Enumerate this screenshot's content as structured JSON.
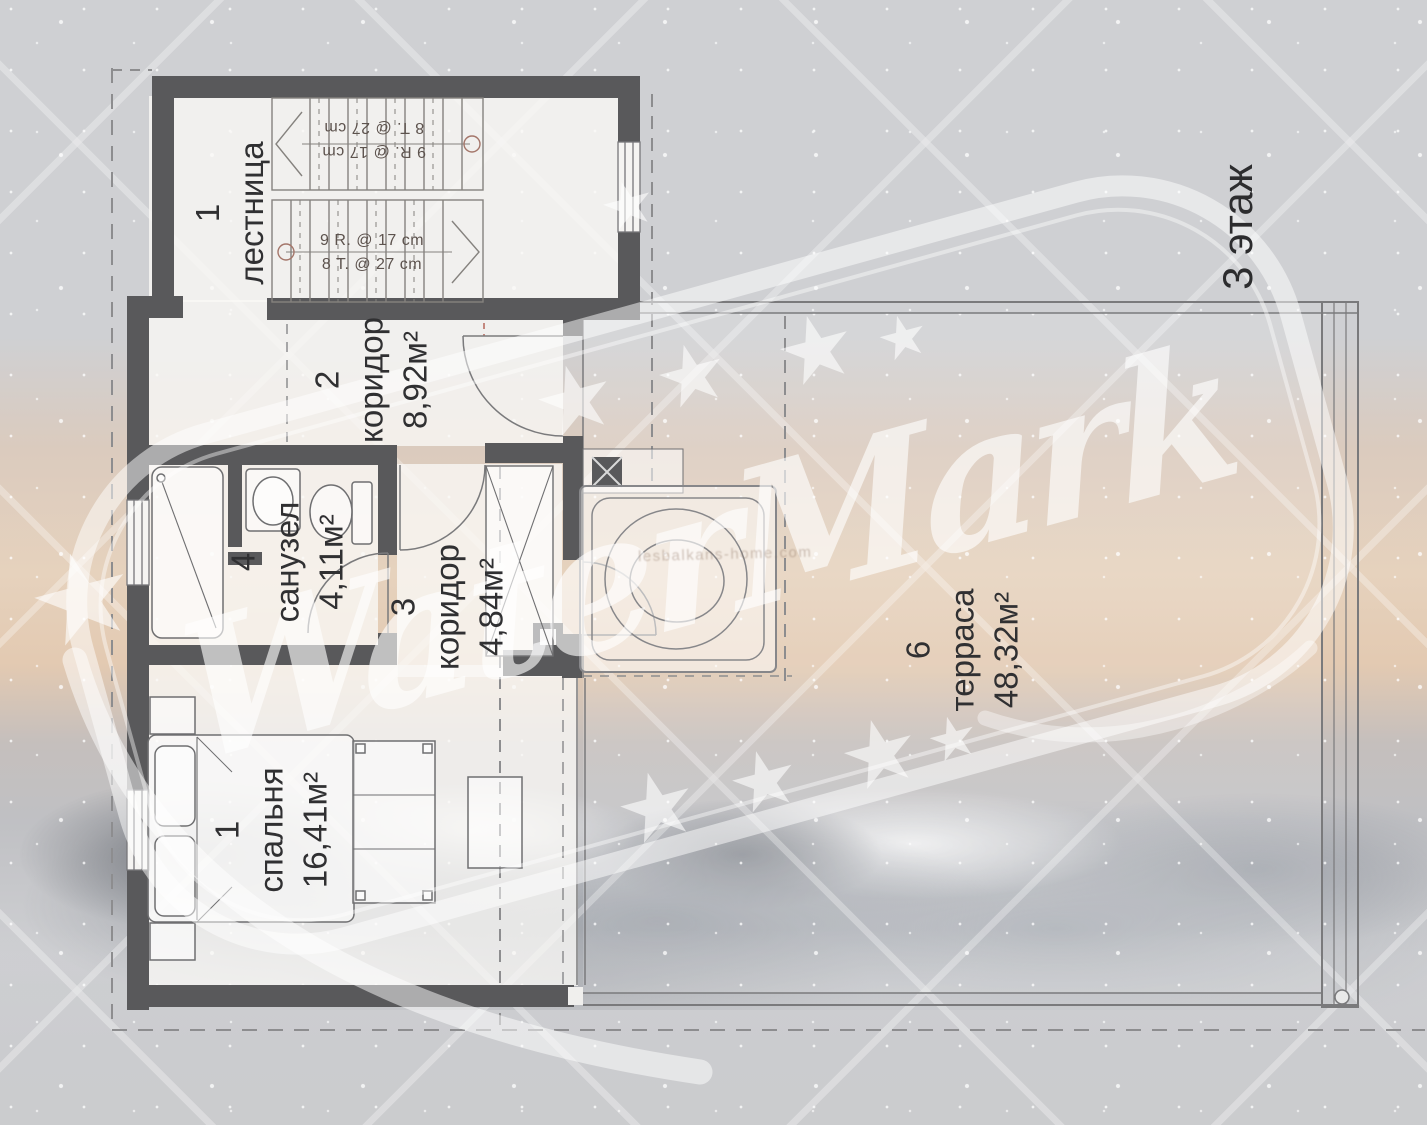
{
  "floor_label": "3 этаж",
  "watermark": {
    "text": "WaterMark",
    "url_text": "lesbalkans-home.com"
  },
  "rooms": [
    {
      "number": "1",
      "name": "лестница",
      "area": ""
    },
    {
      "number": "2",
      "name": "коридор",
      "area": "8,92м²"
    },
    {
      "number": "3",
      "name": "коридор",
      "area": "4,84м²"
    },
    {
      "number": "4",
      "name": "санузел",
      "area": "4,11м²"
    },
    {
      "number": "1",
      "name": "спальня",
      "area": "16,41м²"
    },
    {
      "number": "6",
      "name": "терраса",
      "area": "48,32м²"
    }
  ],
  "stairs": {
    "upper": [
      "9 R. @ 17 cm",
      "8 T. @ 27 cm"
    ],
    "lower": [
      "9 R. @ 17 cm",
      "8 T. @ 27 cm"
    ]
  }
}
